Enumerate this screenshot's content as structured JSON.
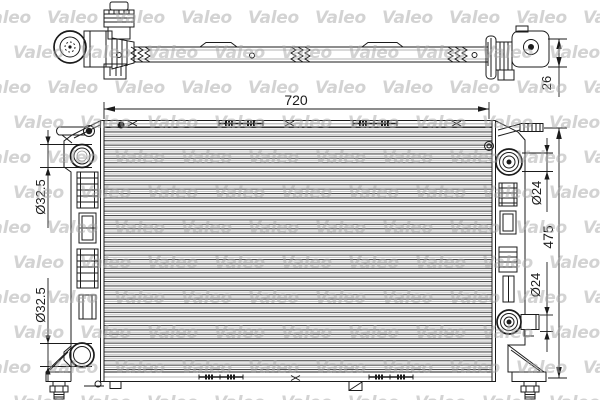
{
  "document": {
    "type": "radiator-technical-drawing",
    "brand": "Valeo"
  },
  "watermark": {
    "text": "Valeo",
    "color": "#d4d4d4"
  },
  "dimensions": {
    "overall_width": "720",
    "overall_height": "475",
    "core_depth": "26",
    "left_upper_port_diameter": "Ø32.5",
    "left_lower_port_diameter": "Ø32.5",
    "right_upper_port_diameter": "Ø24",
    "right_lower_port_diameter": "Ø24"
  }
}
